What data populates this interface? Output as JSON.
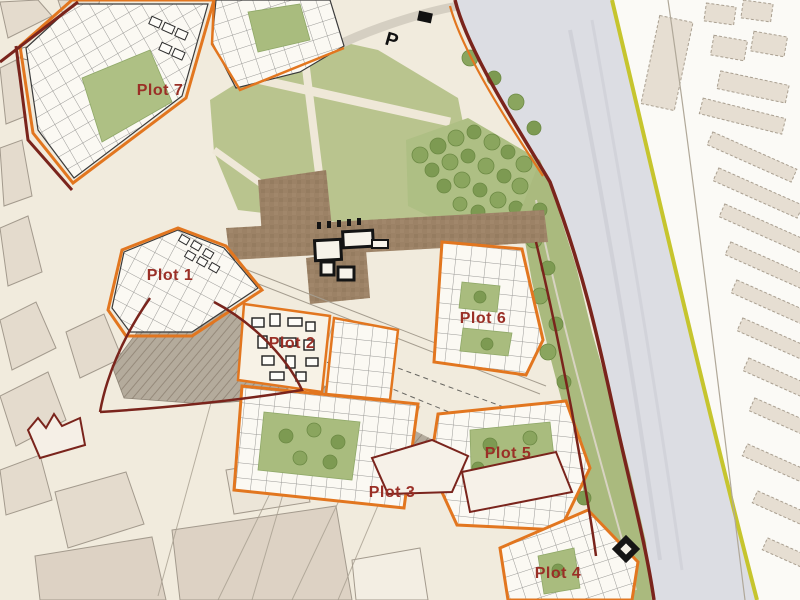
{
  "map": {
    "type": "urban-masterplan-site-map",
    "plots": [
      {
        "id": "plot-1",
        "label": "Plot 1"
      },
      {
        "id": "plot-2",
        "label": "Plot 2"
      },
      {
        "id": "plot-3",
        "label": "Plot 3"
      },
      {
        "id": "plot-4",
        "label": "Plot 4"
      },
      {
        "id": "plot-5",
        "label": "Plot 5"
      },
      {
        "id": "plot-6",
        "label": "Plot 6"
      },
      {
        "id": "plot-7",
        "label": "Plot 7"
      }
    ],
    "markers": {
      "parking": "P"
    },
    "colors": {
      "background": "#f1ebdd",
      "plot_outline": "#e2761f",
      "site_boundary": "#7a241c",
      "plot_label": "#9a2f26",
      "park_green": "#b9c48e",
      "courtyard_green": "#a9bc7e",
      "tree_green": "#84a156",
      "plaza_brown": "#9c8266",
      "river_grey": "#dcdde3",
      "boundary_yellow": "#c6c52e",
      "existing_building": "#e4dbcd",
      "new_building": "#fbf9f3"
    }
  }
}
